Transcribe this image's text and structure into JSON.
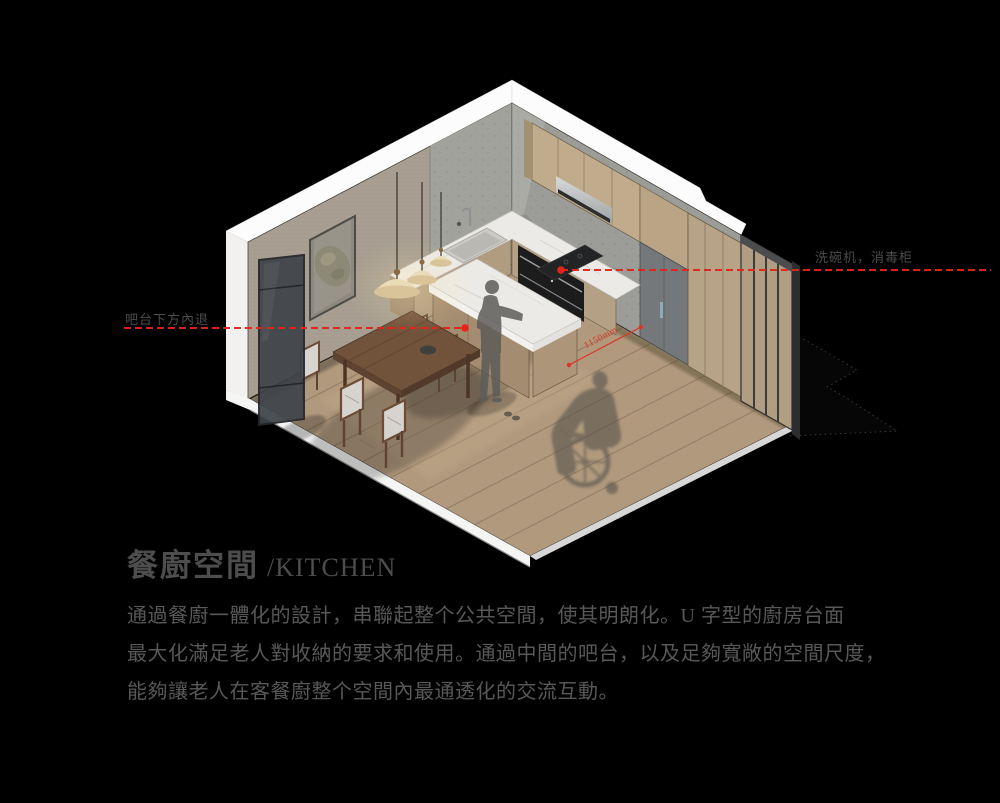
{
  "page": {
    "background": "#000000",
    "width": 1000,
    "height": 803
  },
  "title": {
    "cn": "餐廚空間",
    "en": "/KITCHEN"
  },
  "paragraph": {
    "lines": [
      "通過餐廚一體化的設計，串聯起整个公共空間，使其明朗化。U 字型的廚房台面",
      "最大化滿足老人對收納的要求和使用。通過中間的吧台，以及足夠寬敞的空間尺度，",
      "能夠讓老人在客餐廚整个空間內最通透化的交流互動。"
    ]
  },
  "annotations": {
    "left_label": "吧台下方內退",
    "right_label": "洗碗机，消毒柜",
    "dimension_label": "1150mm"
  },
  "colors": {
    "accent_red": "#e6231a",
    "label_gray": "#4c4c4c",
    "title_gray": "#4d4d4d",
    "body_gray": "#585858",
    "wall_beige": "#a89f92",
    "wall_concrete": "#9c9d98",
    "cabinet_wood": "#c0ac8c",
    "floor_wood": "#b0997d",
    "marble": "#eceae6",
    "table_walnut": "#6e5039",
    "slab_white": "#f5f5f4"
  }
}
